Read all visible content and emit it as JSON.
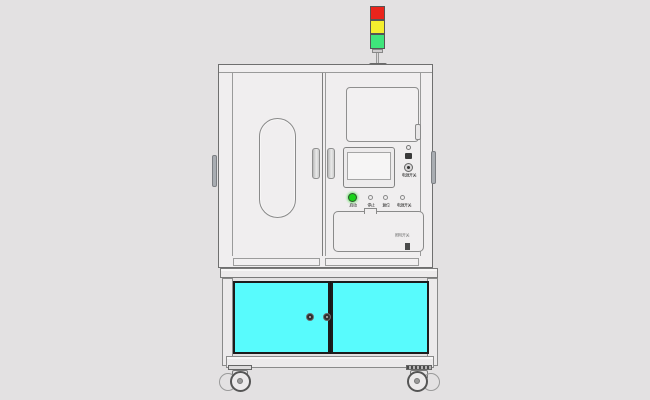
{
  "scene": {
    "background_color": "#e3e1e2"
  },
  "stack_light": {
    "segments": [
      {
        "name": "red",
        "color": "#ea241c"
      },
      {
        "name": "yellow",
        "color": "#f4ee2e"
      },
      {
        "name": "green",
        "color": "#3fe57b"
      }
    ]
  },
  "upper_cabinet": {
    "body_color": "#f0eeef",
    "control_panel": {
      "buttons": [
        {
          "label": "启动",
          "color": "#17d417",
          "lit": true
        },
        {
          "label": "停止",
          "color": "#efedee",
          "lit": false
        },
        {
          "label": "复位",
          "color": "#efedee",
          "lit": false
        },
        {
          "label": "电源开关",
          "color": "#efedee",
          "lit": false
        }
      ],
      "side_controls": {
        "selector_label": "电源开关",
        "lower_label": "照明开关"
      }
    }
  },
  "lower_cabinet": {
    "door_color": "#58fbfd"
  }
}
